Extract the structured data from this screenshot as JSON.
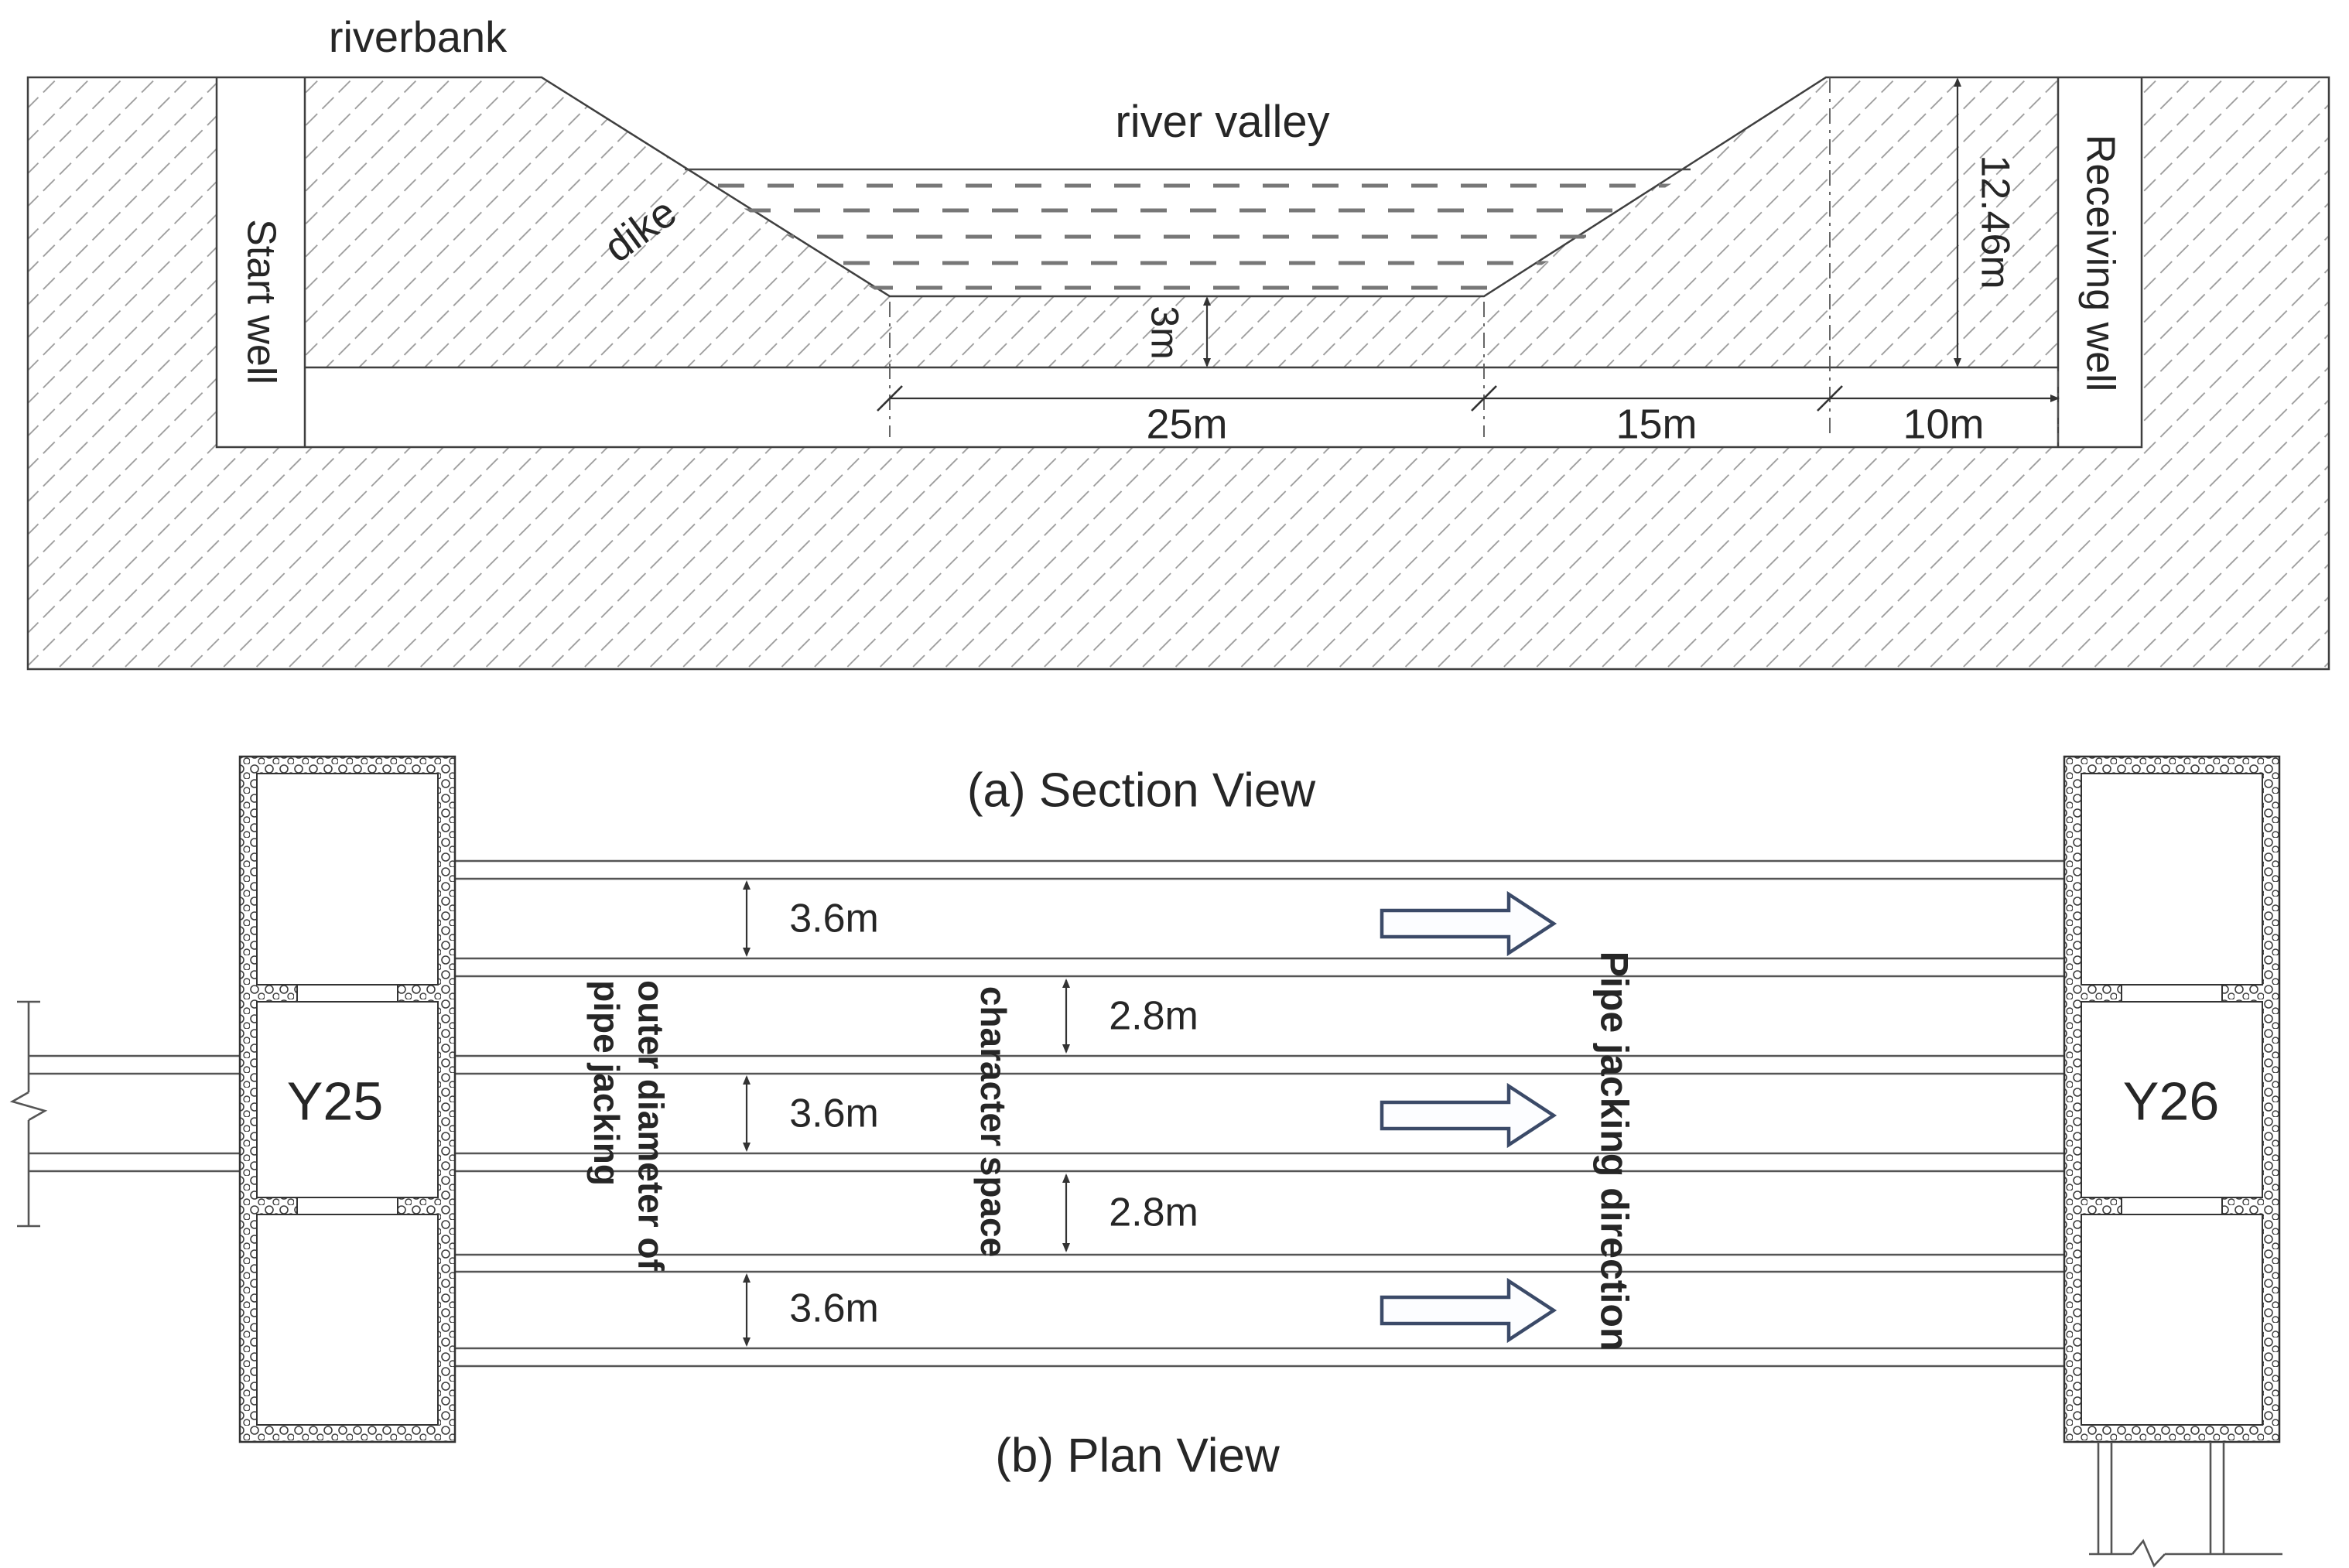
{
  "section": {
    "caption": "(a) Section View",
    "labels": {
      "riverbank": "riverbank",
      "dike": "dike",
      "river_valley": "river valley",
      "start_well": "Start well",
      "receiving_well": "Receiving well"
    },
    "dims": {
      "cover_depth": "3m",
      "riverbed_width": "25m",
      "slope_width": "15m",
      "bank_width": "10m",
      "well_depth": "12.46m"
    }
  },
  "plan": {
    "caption": "(b) Plan View",
    "start_shaft_label": "Y25",
    "receive_shaft_label": "Y26",
    "od_label": "3.6m",
    "space_label": "2.8m",
    "outer_diameter_note": "outer diameter of\npipe jacking",
    "character_space_note": "character space",
    "direction_note": "Pipe jacking direction"
  },
  "colors": {
    "line": "#3f3f3f",
    "hatch": "#9a9a9a",
    "water": "#777777",
    "arrow_outline": "#3b4a68"
  }
}
